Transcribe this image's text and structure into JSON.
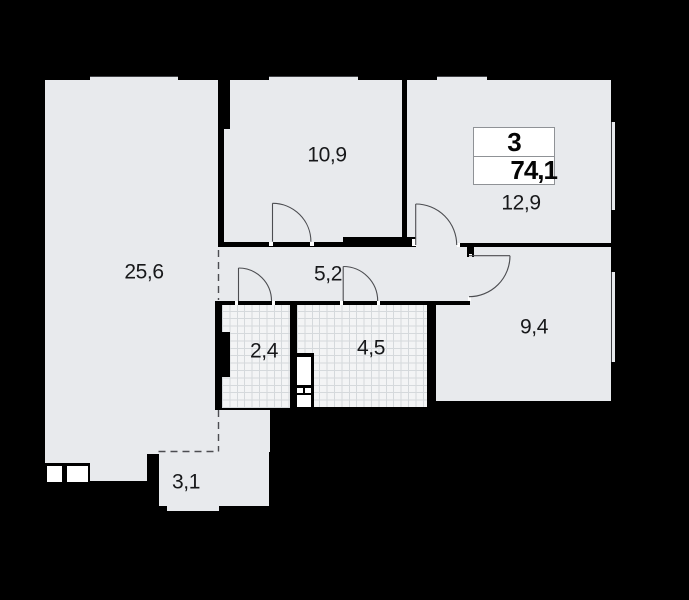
{
  "plan_title": "apartment-floor-plan",
  "badge": {
    "rooms_count": "3",
    "total_area": "74,1"
  },
  "labels": {
    "living": "25,6",
    "bedroom_top": "10,9",
    "bedroom_right": "12,9",
    "corridor": "5,2",
    "wc": "2,4",
    "bathroom": "4,5",
    "bedroom_small": "9,4",
    "balcony": "3,1"
  },
  "colors": {
    "background": "#000000",
    "floor": "#e8eaed",
    "tile_floor": "#f3f4f5",
    "tile_line": "#d5d9dc",
    "wall": "#000000",
    "stroke": "#4c4d51",
    "badge_border": "#8f9296",
    "text": "#17181a"
  }
}
